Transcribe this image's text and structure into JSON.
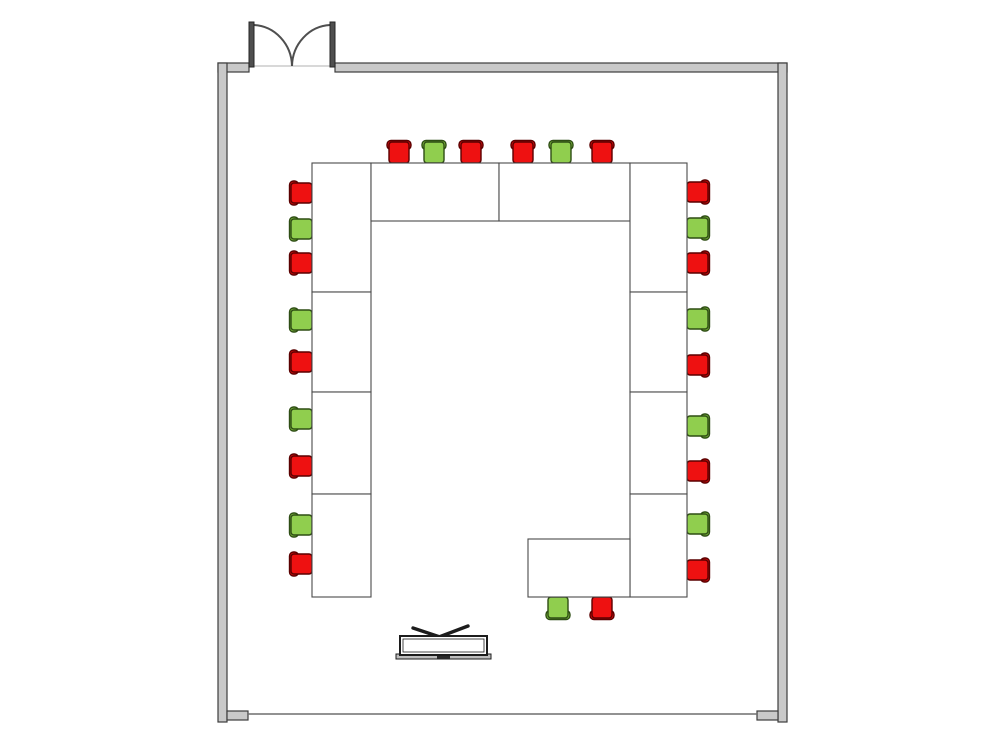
{
  "palette": {
    "floor_fill": "#ffffff",
    "wall_fill": "#c9c9c9",
    "wall_stroke": "#3d3d3d",
    "table_fill": "#ffffff",
    "table_stroke": "#4a4a4a",
    "door_leaf_fill": "#4f4f4f",
    "door_leaf_stroke": "#262626",
    "door_arc_stroke": "#4f4f4f",
    "threshold_stroke": "#d8d8d8",
    "bottom_line_stroke": "#6e6e6e",
    "chair_red_seat": "#ee1111",
    "chair_red_back": "#dd0c0c",
    "chair_red_stroke": "#5a0000",
    "chair_green_seat": "#90ce4e",
    "chair_green_back": "#83c03f",
    "chair_green_stroke": "#2e4d14",
    "screen_stroke": "#1c1c1c",
    "screen_base_fill": "#bdbdbd",
    "screen_dash_fill": "#2a2a2a"
  },
  "floor_plan": {
    "canvas": {
      "w": 1000,
      "h": 751
    },
    "room": {
      "interior": {
        "x": 227,
        "y": 72,
        "w": 551,
        "h": 643
      },
      "walls": [
        {
          "name": "wall-top-left-segment",
          "x": 218,
          "y": 63,
          "w": 31,
          "h": 9
        },
        {
          "name": "wall-top",
          "x": 335,
          "y": 63,
          "w": 452,
          "h": 9
        },
        {
          "name": "wall-left",
          "x": 218,
          "y": 63,
          "w": 9,
          "h": 659
        },
        {
          "name": "wall-right",
          "x": 778,
          "y": 63,
          "w": 9,
          "h": 659
        }
      ],
      "bottom_caps": [
        {
          "x": 227,
          "y": 711,
          "w": 21,
          "h": 9
        },
        {
          "x": 757,
          "y": 711,
          "w": 21,
          "h": 9
        }
      ],
      "bottom_line": {
        "x1": 248,
        "y1": 714,
        "x2": 757,
        "y2": 714
      },
      "door": {
        "left_leaf": {
          "x": 249,
          "y": 22,
          "w": 5,
          "h": 45
        },
        "right_leaf": {
          "x": 330,
          "y": 22,
          "w": 5,
          "h": 45
        },
        "arc_left": "M 254 25 A 40 42 0 0 1 292 66",
        "arc_right": "M 330 25 A 40 42 0 0 0 292 66",
        "threshold": {
          "x1": 254,
          "y1": 66,
          "x2": 330,
          "y2": 66
        }
      }
    },
    "tables": [
      {
        "id": "table-left-1",
        "x": 312,
        "y": 163,
        "w": 59,
        "h": 129
      },
      {
        "id": "table-left-2",
        "x": 312,
        "y": 292,
        "w": 59,
        "h": 100
      },
      {
        "id": "table-left-3",
        "x": 312,
        "y": 392,
        "w": 59,
        "h": 102
      },
      {
        "id": "table-left-4",
        "x": 312,
        "y": 494,
        "w": 59,
        "h": 103
      },
      {
        "id": "table-top-a",
        "x": 371,
        "y": 163,
        "w": 128,
        "h": 58
      },
      {
        "id": "table-top-b",
        "x": 499,
        "y": 163,
        "w": 131,
        "h": 58
      },
      {
        "id": "table-right-1",
        "x": 630,
        "y": 163,
        "w": 57,
        "h": 129
      },
      {
        "id": "table-right-2",
        "x": 630,
        "y": 292,
        "w": 57,
        "h": 100
      },
      {
        "id": "table-right-3",
        "x": 630,
        "y": 392,
        "w": 57,
        "h": 102
      },
      {
        "id": "table-right-4",
        "x": 630,
        "y": 494,
        "w": 57,
        "h": 103
      },
      {
        "id": "table-bottom-right",
        "x": 528,
        "y": 539,
        "w": 102,
        "h": 58
      }
    ],
    "chairs": {
      "edges": {
        "top": 152,
        "left": 301,
        "right": 698,
        "bottom": 608
      },
      "rotations": {
        "top": 0,
        "left": -90,
        "right": 90,
        "bottom": 180
      },
      "items": [
        {
          "side": "top",
          "pos": 399,
          "color": "red"
        },
        {
          "side": "top",
          "pos": 434,
          "color": "green"
        },
        {
          "side": "top",
          "pos": 471,
          "color": "red"
        },
        {
          "side": "top",
          "pos": 523,
          "color": "red"
        },
        {
          "side": "top",
          "pos": 561,
          "color": "green"
        },
        {
          "side": "top",
          "pos": 602,
          "color": "red"
        },
        {
          "side": "left",
          "pos": 193,
          "color": "red"
        },
        {
          "side": "left",
          "pos": 229,
          "color": "green"
        },
        {
          "side": "left",
          "pos": 263,
          "color": "red"
        },
        {
          "side": "left",
          "pos": 320,
          "color": "green"
        },
        {
          "side": "left",
          "pos": 362,
          "color": "red"
        },
        {
          "side": "left",
          "pos": 419,
          "color": "green"
        },
        {
          "side": "left",
          "pos": 466,
          "color": "red"
        },
        {
          "side": "left",
          "pos": 525,
          "color": "green"
        },
        {
          "side": "left",
          "pos": 564,
          "color": "red"
        },
        {
          "side": "right",
          "pos": 192,
          "color": "red"
        },
        {
          "side": "right",
          "pos": 228,
          "color": "green"
        },
        {
          "side": "right",
          "pos": 263,
          "color": "red"
        },
        {
          "side": "right",
          "pos": 319,
          "color": "green"
        },
        {
          "side": "right",
          "pos": 365,
          "color": "red"
        },
        {
          "side": "right",
          "pos": 426,
          "color": "green"
        },
        {
          "side": "right",
          "pos": 471,
          "color": "red"
        },
        {
          "side": "right",
          "pos": 524,
          "color": "green"
        },
        {
          "side": "right",
          "pos": 570,
          "color": "red"
        },
        {
          "side": "bottom",
          "pos": 558,
          "color": "green"
        },
        {
          "side": "bottom",
          "pos": 602,
          "color": "red"
        }
      ]
    },
    "screen": {
      "frame": {
        "x": 400,
        "y": 636,
        "w": 87,
        "h": 19
      },
      "inner_inset": 3,
      "base": {
        "x": 396,
        "y": 654,
        "w": 95,
        "h": 5
      },
      "dash": {
        "x": 437,
        "y": 656,
        "w": 13,
        "h": 3
      },
      "antenna": [
        {
          "x1": 443,
          "y1": 638,
          "x2": 413,
          "y2": 628
        },
        {
          "x1": 439,
          "y1": 637,
          "x2": 468,
          "y2": 626
        }
      ]
    }
  }
}
